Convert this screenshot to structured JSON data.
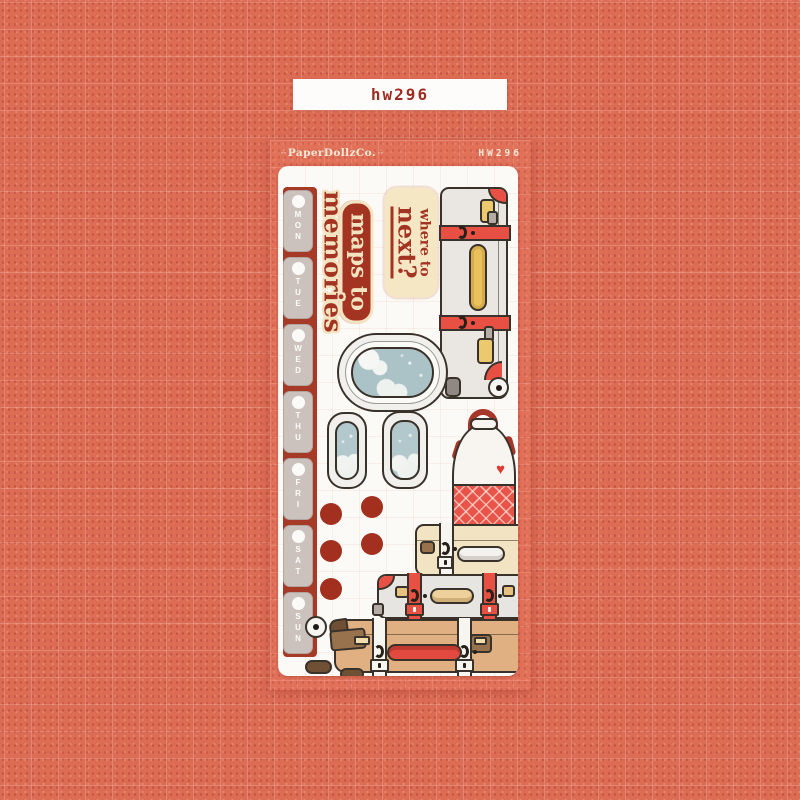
{
  "colors": {
    "background_coral": "#dd6c55",
    "card_salmon": "#e2715a",
    "sheet_white": "#fcfaf6",
    "dark_red": "#a33422",
    "cream": "#f3e3c1",
    "strap_red": "#e85044",
    "tab_gray": "#cbc2be",
    "window_blue": "#abc2c7",
    "suitcase_tan": "#e0b082",
    "handle_yellow": "#eac25c"
  },
  "top_label": {
    "text": "hw296"
  },
  "card": {
    "brand": "PaperDollzCo.",
    "brand_decor_left": "∴",
    "brand_decor_right": "∴",
    "sku": "HW296"
  },
  "sheet": {
    "day_tabs": [
      "MON",
      "TUE",
      "WED",
      "THU",
      "FRI",
      "SAT",
      "SUN"
    ],
    "stickers": {
      "maps_to_memories": {
        "line1": "maps to",
        "line2": "memories"
      },
      "where_to_next": {
        "line1": "where to",
        "line2": "next?"
      }
    },
    "icons": {
      "heart": "♥"
    },
    "dot_sticker_count": 5,
    "art_stickers": [
      "day-tab-strip",
      "maps-to-memories-text",
      "where-to-next-text",
      "rolling-suitcase",
      "airplane-window-large",
      "airplane-window-small-left",
      "airplane-window-small-right",
      "red-dots",
      "backpack",
      "cream-suitcase",
      "gray-suitcase",
      "tan-suitcase"
    ]
  }
}
